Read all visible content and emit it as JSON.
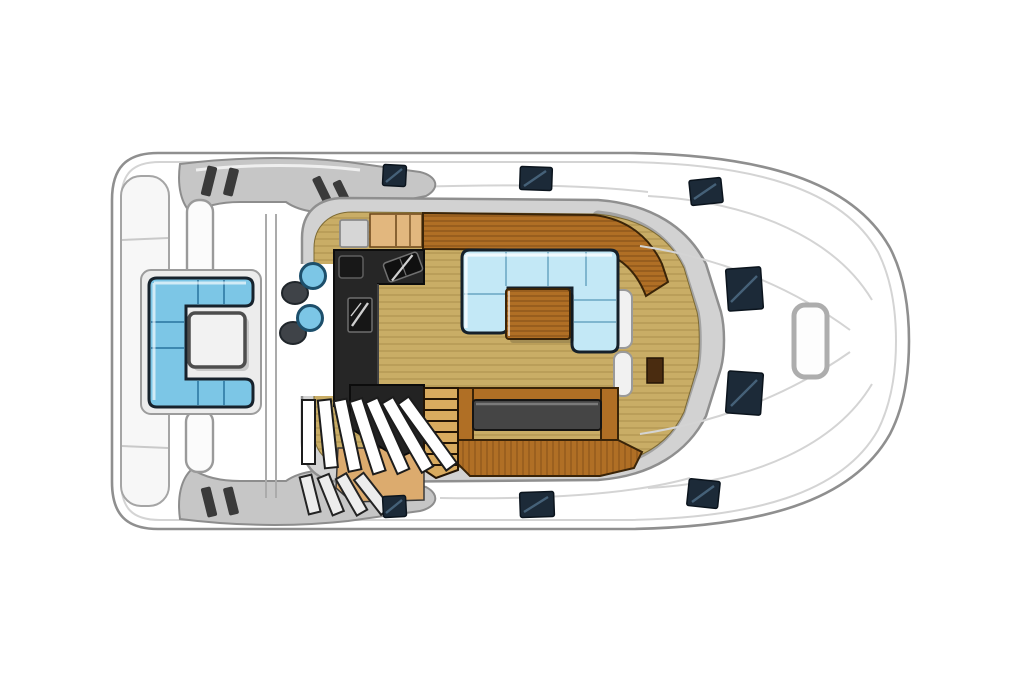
{
  "canvas": {
    "width": 1024,
    "height": 683,
    "background": "#ffffff"
  },
  "diagram": {
    "type": "yacht-deck-plan",
    "view": "top-down",
    "orientation": "bow-right",
    "areas": {
      "stern": [
        "swim-platform"
      ],
      "aft-cockpit": [
        "c-shaped-settee",
        "cocktail-table",
        "stool-pair-1",
        "stool-pair-2"
      ],
      "salon": [
        "galley-l-counter",
        "galley-sink",
        "galley-cooktop",
        "forward-cabinets",
        "forward-counter",
        "dinette-settee",
        "dinette-table",
        "aft-bench",
        "bench-cushion",
        "tv-cabinet",
        "side-steps"
      ],
      "stairways": [
        "salon-staircase",
        "hull-ladder",
        "stair-landing"
      ],
      "foredeck": [
        "deck-hatch",
        "deck-hatch",
        "anchor-locker"
      ],
      "side-decks": [
        "deck-hatch",
        "deck-hatch",
        "deck-hatch",
        "deck-hatch",
        "deck-hatch",
        "deck-hatch"
      ],
      "superstructure": [
        "arch-steps-top",
        "arch-steps-bottom",
        "stanchion-post-top",
        "stanchion-post-bottom"
      ]
    }
  },
  "palette": {
    "hull-outline": "#8f8f8f",
    "structure-gray": "#c6c6c6",
    "coachroof-gray": "#d2d2d2",
    "windshield-gray": "#a3a3a3",
    "floor-tan": "#c9ad66",
    "floor-line": "#a8863e",
    "wood-brown": "#b06f25",
    "wood-light": "#e2b77e",
    "wood-outline": "#3a2408",
    "galley-black": "#262626",
    "hatch-navy": "#1c2a38",
    "hatch-sheen": "#4a6780",
    "salon-cushion": "#c3e8f6",
    "salon-cushion-line": "#7fb6cf",
    "cockpit-cushion": "#7cc6e6",
    "cockpit-cushion-line": "#3d88b0",
    "cushion-outline": "#17222c",
    "table-white": "#f2f2f2",
    "seat-dark": "#3f4348",
    "bench-cushion": "#454545"
  }
}
